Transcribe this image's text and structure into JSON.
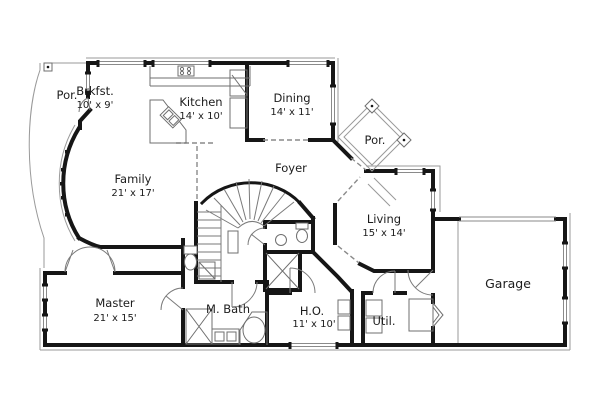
{
  "title": "House floor plan",
  "colors": {
    "background": "#ffffff",
    "wall": "#161616",
    "thin_line": "#7a7a7a",
    "text": "#1c1c1c"
  },
  "rooms": [
    {
      "name": "porch-left",
      "label": "Por."
    },
    {
      "name": "breakfast",
      "label": "Brkfst.",
      "dims": "10' x 9'"
    },
    {
      "name": "kitchen",
      "label": "Kitchen",
      "dims": "14' x 10'"
    },
    {
      "name": "dining",
      "label": "Dining",
      "dims": "14' x 11'"
    },
    {
      "name": "porch-right",
      "label": "Por."
    },
    {
      "name": "foyer",
      "label": "Foyer"
    },
    {
      "name": "family",
      "label": "Family",
      "dims": "21' x 17'"
    },
    {
      "name": "living",
      "label": "Living",
      "dims": "15' x 14'"
    },
    {
      "name": "garage",
      "label": "Garage"
    },
    {
      "name": "master",
      "label": "Master",
      "dims": "21' x 15'"
    },
    {
      "name": "master-bath",
      "label": "M. Bath"
    },
    {
      "name": "home-office",
      "label": "H.O.",
      "dims": "11' x 10'"
    },
    {
      "name": "utility",
      "label": "Util."
    }
  ],
  "fixtures": [
    "curved-staircase",
    "straight-stair-run",
    "toilet",
    "bathtub-oval",
    "kitchen-corner-sink",
    "range-cooktop",
    "closet-x",
    "door-swing",
    "porch-column-diamond",
    "bay-window-curve",
    "water-heater-closet"
  ]
}
